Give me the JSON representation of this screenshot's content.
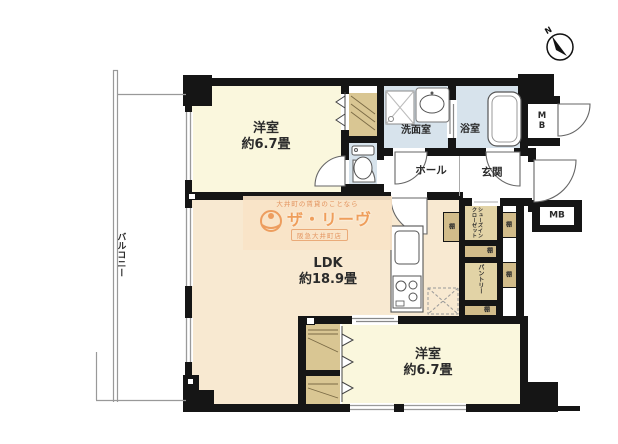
{
  "compass": {
    "north_label": "N"
  },
  "rooms": {
    "bedroom_top": {
      "name": "洋室",
      "size": "約6.7畳"
    },
    "bedroom_bottom": {
      "name": "洋室",
      "size": "約6.7畳"
    },
    "ldk": {
      "name": "LDK",
      "size": "約18.9畳"
    },
    "washroom": {
      "name": "洗面室"
    },
    "bathroom": {
      "name": "浴室"
    },
    "hall": {
      "name": "ホール"
    },
    "entrance": {
      "name": "玄関"
    },
    "balcony": {
      "name": "バルコニー"
    },
    "shoes_in_closet": {
      "name": "シューズインクローゼット"
    },
    "pantry": {
      "name": "パントリー"
    }
  },
  "fixtures": {
    "shelf_label": "棚",
    "meter_box_top": {
      "label": "MB"
    },
    "meter_box_side": {
      "label": "MB"
    }
  },
  "watermark": {
    "tagline": "大井町の賃貸のことなら",
    "brand": "ザ・リーヴ",
    "store": "阪急大井町店"
  },
  "colors": {
    "wall": "#151515",
    "bedroom_fill": "#FAF7DD",
    "ldk_fill": "#F8E9D1",
    "wet_area_fill": "#D7E3EC",
    "closet_fill": "#D9C693",
    "watermark_orange": "#ED9D5E"
  }
}
